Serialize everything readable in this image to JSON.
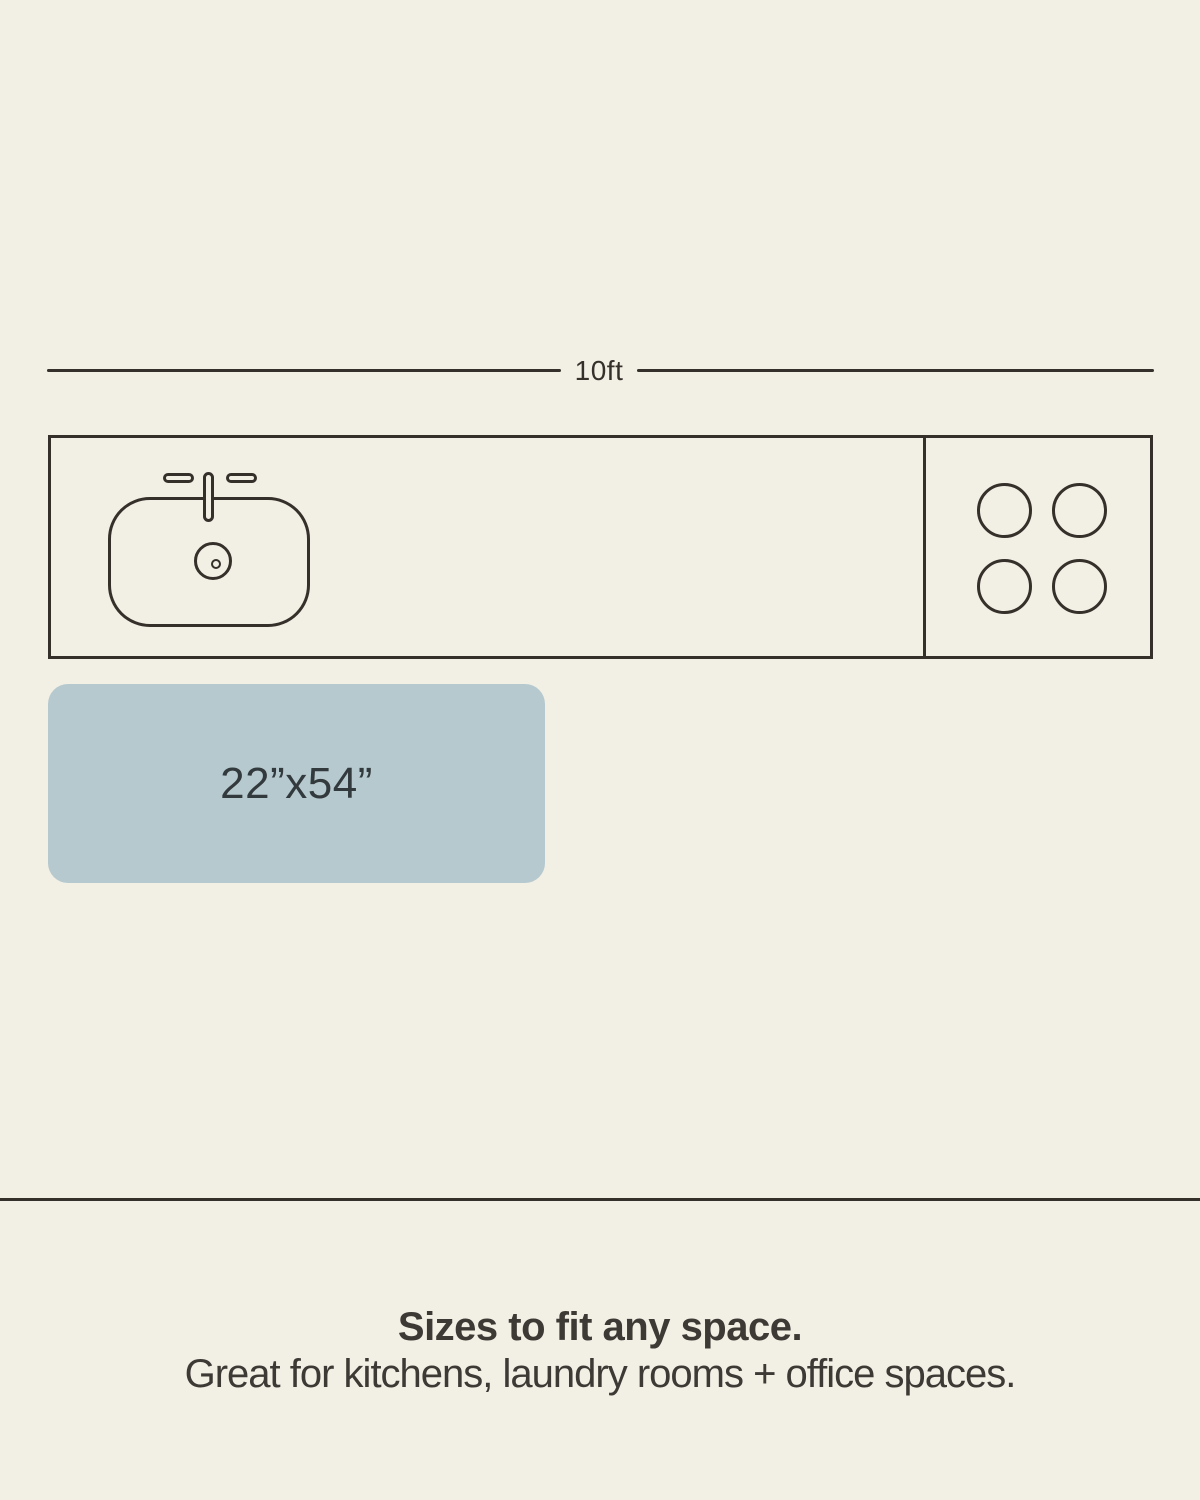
{
  "canvas": {
    "background": "#f2efe5",
    "stroke_color": "#35302a"
  },
  "dimension": {
    "label": "10ft"
  },
  "mat": {
    "label": "22”x54”",
    "fill": "#b6c9ce",
    "label_color": "#333a3d"
  },
  "footer": {
    "heading": "Sizes to fit any space.",
    "subheading": "Great for kitchens, laundry rooms + office spaces.",
    "text_color": "#3d3934"
  }
}
